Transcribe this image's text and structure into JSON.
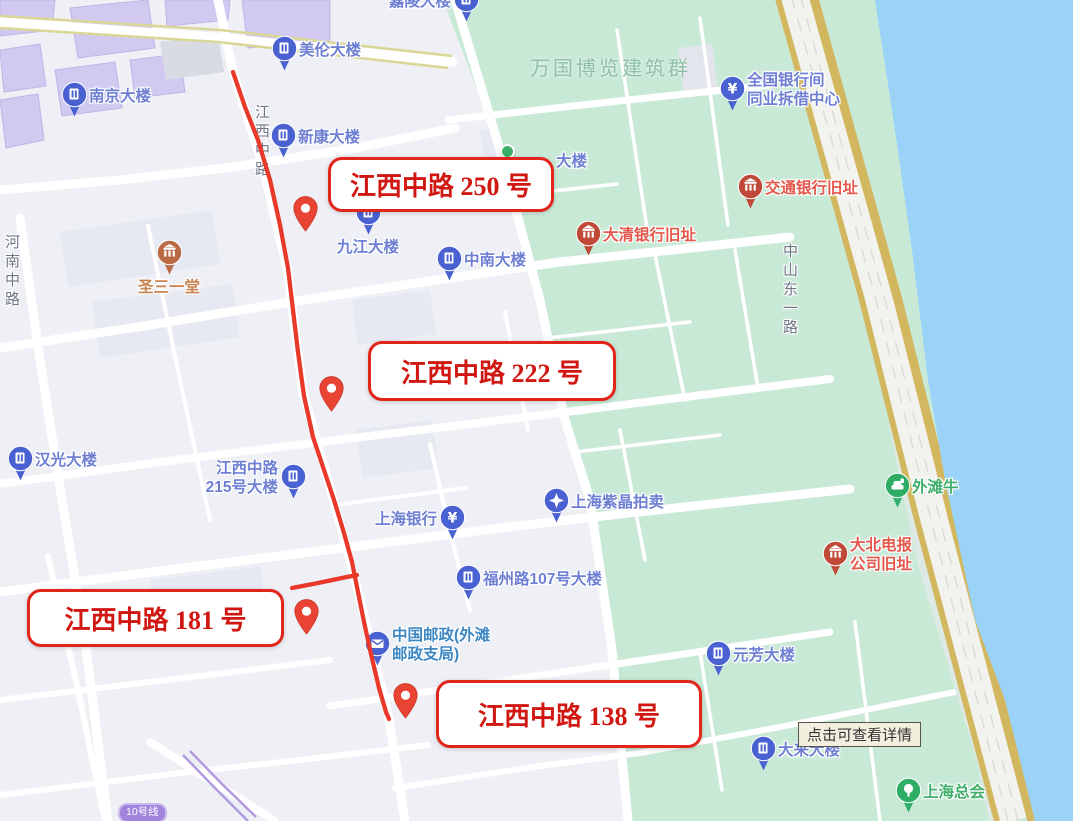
{
  "map": {
    "colors": {
      "land": "#eef0f6",
      "block": "#e7e9f2",
      "purple_building": "#d2c9f0",
      "green_area": "#c9e9d7",
      "water": "#9ad2f8",
      "road_gold": "#d2b75f",
      "promenade": "#dde9e4",
      "metro_purple": "#b39be2",
      "route_red": "#e8392b",
      "blue_pin": "#4a61d1",
      "blue_text": "#6e7fd3",
      "red_pin": "#bf4936",
      "red_text": "#e4574b",
      "orange_pin": "#b96a45",
      "orange_text": "#c98350",
      "green_pin": "#2fad66",
      "green_text": "#3fae6a",
      "teal_text": "#3d87c2"
    },
    "area_label": {
      "text": "万国博览建筑群",
      "x": 530,
      "y": 52
    },
    "road_labels": [
      {
        "text": "河南中路",
        "x": 1,
        "y": 234
      },
      {
        "text": "江西中路",
        "x": 251,
        "y": 104
      },
      {
        "text": "中山东一路",
        "x": 779,
        "y": 243
      }
    ],
    "partial_label": {
      "text": "大楼",
      "x": 556,
      "y": 149
    },
    "pois": [
      {
        "id": "nanjing-building",
        "label": "南京大楼",
        "x": 74,
        "y": 118,
        "side": "right",
        "pin": "building",
        "color": "blue"
      },
      {
        "id": "meilun-building",
        "label": "美伦大楼",
        "x": 284,
        "y": 72,
        "side": "right",
        "pin": "building",
        "color": "blue"
      },
      {
        "id": "jialing-building",
        "label": "嘉陵大楼",
        "x": 466,
        "y": 23,
        "side": "left",
        "pin": "building",
        "color": "blue"
      },
      {
        "id": "xinkang-building",
        "label": "新康大楼",
        "x": 283,
        "y": 159,
        "side": "right",
        "pin": "building",
        "color": "blue"
      },
      {
        "id": "jiujiang-building",
        "label": "九江大楼",
        "x": 368,
        "y": 236,
        "side": "below",
        "pin": "building",
        "color": "blue"
      },
      {
        "id": "zhongnan-building",
        "label": "中南大楼",
        "x": 449,
        "y": 282,
        "side": "right",
        "pin": "building",
        "color": "blue"
      },
      {
        "id": "daqing-bank-site",
        "label": "大清银行旧址",
        "x": 588,
        "y": 257,
        "side": "right",
        "pin": "heritage",
        "color": "red"
      },
      {
        "id": "jiaotong-bank-site",
        "label": "交通银行旧址",
        "x": 750,
        "y": 210,
        "side": "right",
        "pin": "heritage",
        "color": "red"
      },
      {
        "id": "interbank-center",
        "lines": [
          "全国银行间",
          "同业拆借中心"
        ],
        "x": 732,
        "y": 112,
        "side": "right",
        "pin": "bank",
        "color": "blue"
      },
      {
        "id": "trinity-church",
        "label": "圣三一堂",
        "x": 169,
        "y": 276,
        "side": "below",
        "pin": "heritage",
        "color": "orange"
      },
      {
        "id": "hanguang-building",
        "label": "汉光大楼",
        "x": 20,
        "y": 482,
        "side": "right",
        "pin": "building",
        "color": "blue"
      },
      {
        "id": "jiangxi-215-building",
        "lines": [
          "江西中路",
          "215号大楼"
        ],
        "x": 293,
        "y": 500,
        "side": "left",
        "pin": "building",
        "color": "blue"
      },
      {
        "id": "shanghai-bank",
        "label": "上海银行",
        "x": 452,
        "y": 541,
        "side": "left",
        "pin": "bank",
        "color": "blue"
      },
      {
        "id": "zijing-auction",
        "label": "上海紫晶拍卖",
        "x": 556,
        "y": 524,
        "side": "right",
        "pin": "star",
        "color": "blue"
      },
      {
        "id": "fuzhou-107-building",
        "label": "福州路107号大楼",
        "x": 468,
        "y": 601,
        "side": "right",
        "pin": "building",
        "color": "blue"
      },
      {
        "id": "china-post-bund",
        "lines": [
          "中国邮政(外滩",
          "邮政支局)"
        ],
        "x": 377,
        "y": 667,
        "side": "right",
        "pin": "post",
        "color": "teal"
      },
      {
        "id": "bund-bull",
        "label": "外滩牛",
        "x": 897,
        "y": 509,
        "side": "right",
        "pin": "statue",
        "color": "green"
      },
      {
        "id": "great-northern-telegraph-site",
        "lines": [
          "大北电报",
          "公司旧址"
        ],
        "x": 835,
        "y": 577,
        "side": "right",
        "pin": "heritage",
        "color": "red"
      },
      {
        "id": "yuanfang-building",
        "label": "元芳大楼",
        "x": 718,
        "y": 677,
        "side": "right",
        "pin": "building",
        "color": "blue"
      },
      {
        "id": "dalai-building",
        "label": "大来大楼",
        "x": 763,
        "y": 772,
        "side": "right",
        "pin": "building",
        "color": "blue"
      },
      {
        "id": "shanghai-club",
        "label": "上海总会",
        "x": 908,
        "y": 814,
        "side": "right",
        "pin": "landmark",
        "color": "green"
      }
    ],
    "tree_dot": {
      "x": 507,
      "y": 151
    },
    "route": {
      "color": "#e8392b",
      "width": 4.3,
      "main": [
        [
          233,
          72
        ],
        [
          245,
          107
        ],
        [
          258,
          140
        ],
        [
          270,
          180
        ],
        [
          280,
          225
        ],
        [
          288,
          268
        ],
        [
          293,
          310
        ],
        [
          298,
          352
        ],
        [
          304,
          396
        ],
        [
          313,
          437
        ],
        [
          324,
          470
        ],
        [
          334,
          500
        ],
        [
          344,
          533
        ],
        [
          352,
          562
        ],
        [
          358,
          592
        ],
        [
          364,
          622
        ],
        [
          371,
          654
        ],
        [
          379,
          688
        ],
        [
          386,
          712
        ],
        [
          389,
          719
        ]
      ],
      "spur": [
        [
          292,
          588
        ],
        [
          318,
          583
        ],
        [
          342,
          578
        ],
        [
          357,
          575
        ]
      ]
    },
    "markers": [
      {
        "id": "marker-250",
        "x": 305,
        "y": 231
      },
      {
        "id": "marker-222",
        "x": 331,
        "y": 411
      },
      {
        "id": "marker-181",
        "x": 306,
        "y": 634
      },
      {
        "id": "marker-138",
        "x": 405,
        "y": 718
      }
    ],
    "callouts": [
      {
        "id": "callout-250",
        "text": "江西中路 250 号",
        "x": 328,
        "y": 157,
        "w": 226,
        "h": 55
      },
      {
        "id": "callout-222",
        "text": "江西中路 222 号",
        "x": 368,
        "y": 341,
        "w": 248,
        "h": 60
      },
      {
        "id": "callout-181",
        "text": "江西中路 181 号",
        "x": 27,
        "y": 589,
        "w": 257,
        "h": 58
      },
      {
        "id": "callout-138",
        "text": "江西中路 138 号",
        "x": 436,
        "y": 680,
        "w": 266,
        "h": 68
      }
    ],
    "tooltip": {
      "text": "点击可查看详情",
      "x": 798,
      "y": 722
    },
    "metro_badge": {
      "text": "10号线",
      "x": 118,
      "y": 803
    }
  }
}
